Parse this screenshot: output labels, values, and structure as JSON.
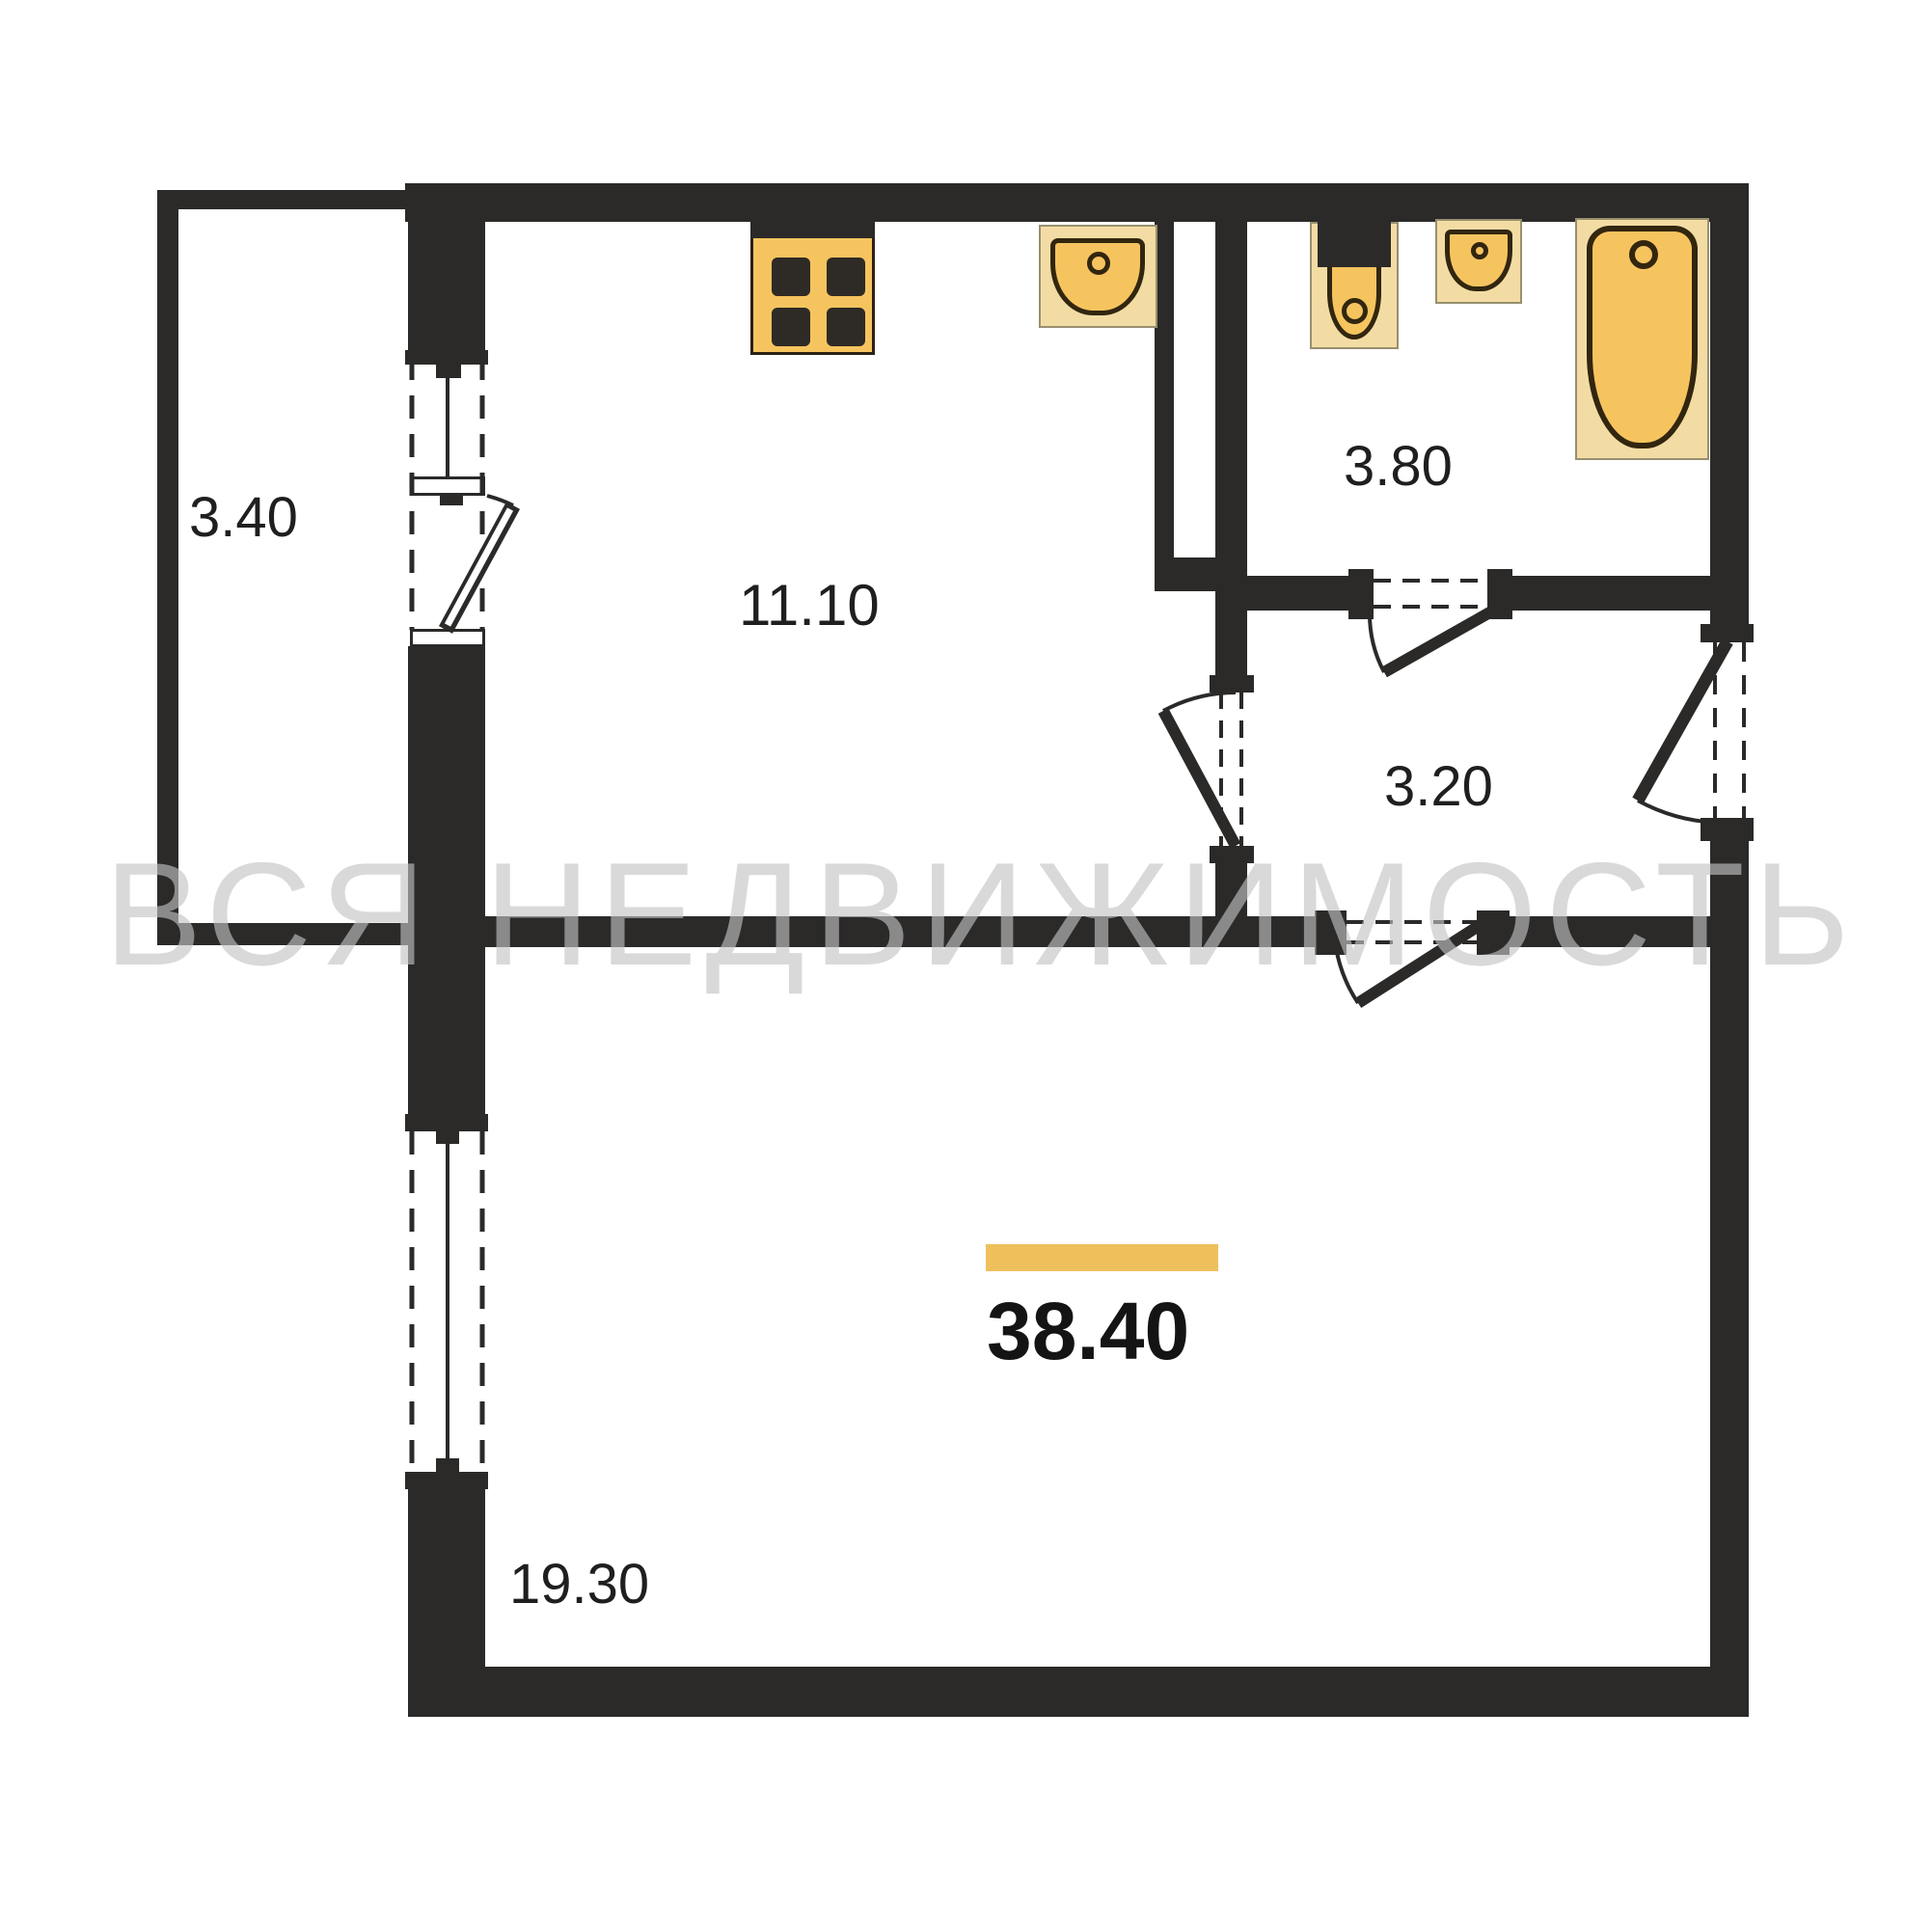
{
  "title": "apartment-floor-plan",
  "watermark": "ВСЯ НЕДВИЖИМОСТЬ",
  "total_area": {
    "value": "38.40"
  },
  "rooms": [
    {
      "name": "balcony",
      "area": "3.40"
    },
    {
      "name": "kitchen",
      "area": "11.10"
    },
    {
      "name": "bathroom",
      "area": "3.80"
    },
    {
      "name": "hallway",
      "area": "3.20"
    },
    {
      "name": "living-room",
      "area": "19.30"
    }
  ],
  "fixtures": [
    {
      "name": "stove-icon"
    },
    {
      "name": "kitchen-sink-icon"
    },
    {
      "name": "toilet-icon"
    },
    {
      "name": "bathroom-sink-icon"
    },
    {
      "name": "bathtub-icon"
    }
  ],
  "colors": {
    "wall": "#2b2a29",
    "fixture_fill": "#f6c45f",
    "fixture_light": "#f3dca4",
    "fixture_outline": "#32260f",
    "highlight_bar": "#eec05c",
    "watermark": "#c3c3c3",
    "label": "#1f1f1f"
  }
}
